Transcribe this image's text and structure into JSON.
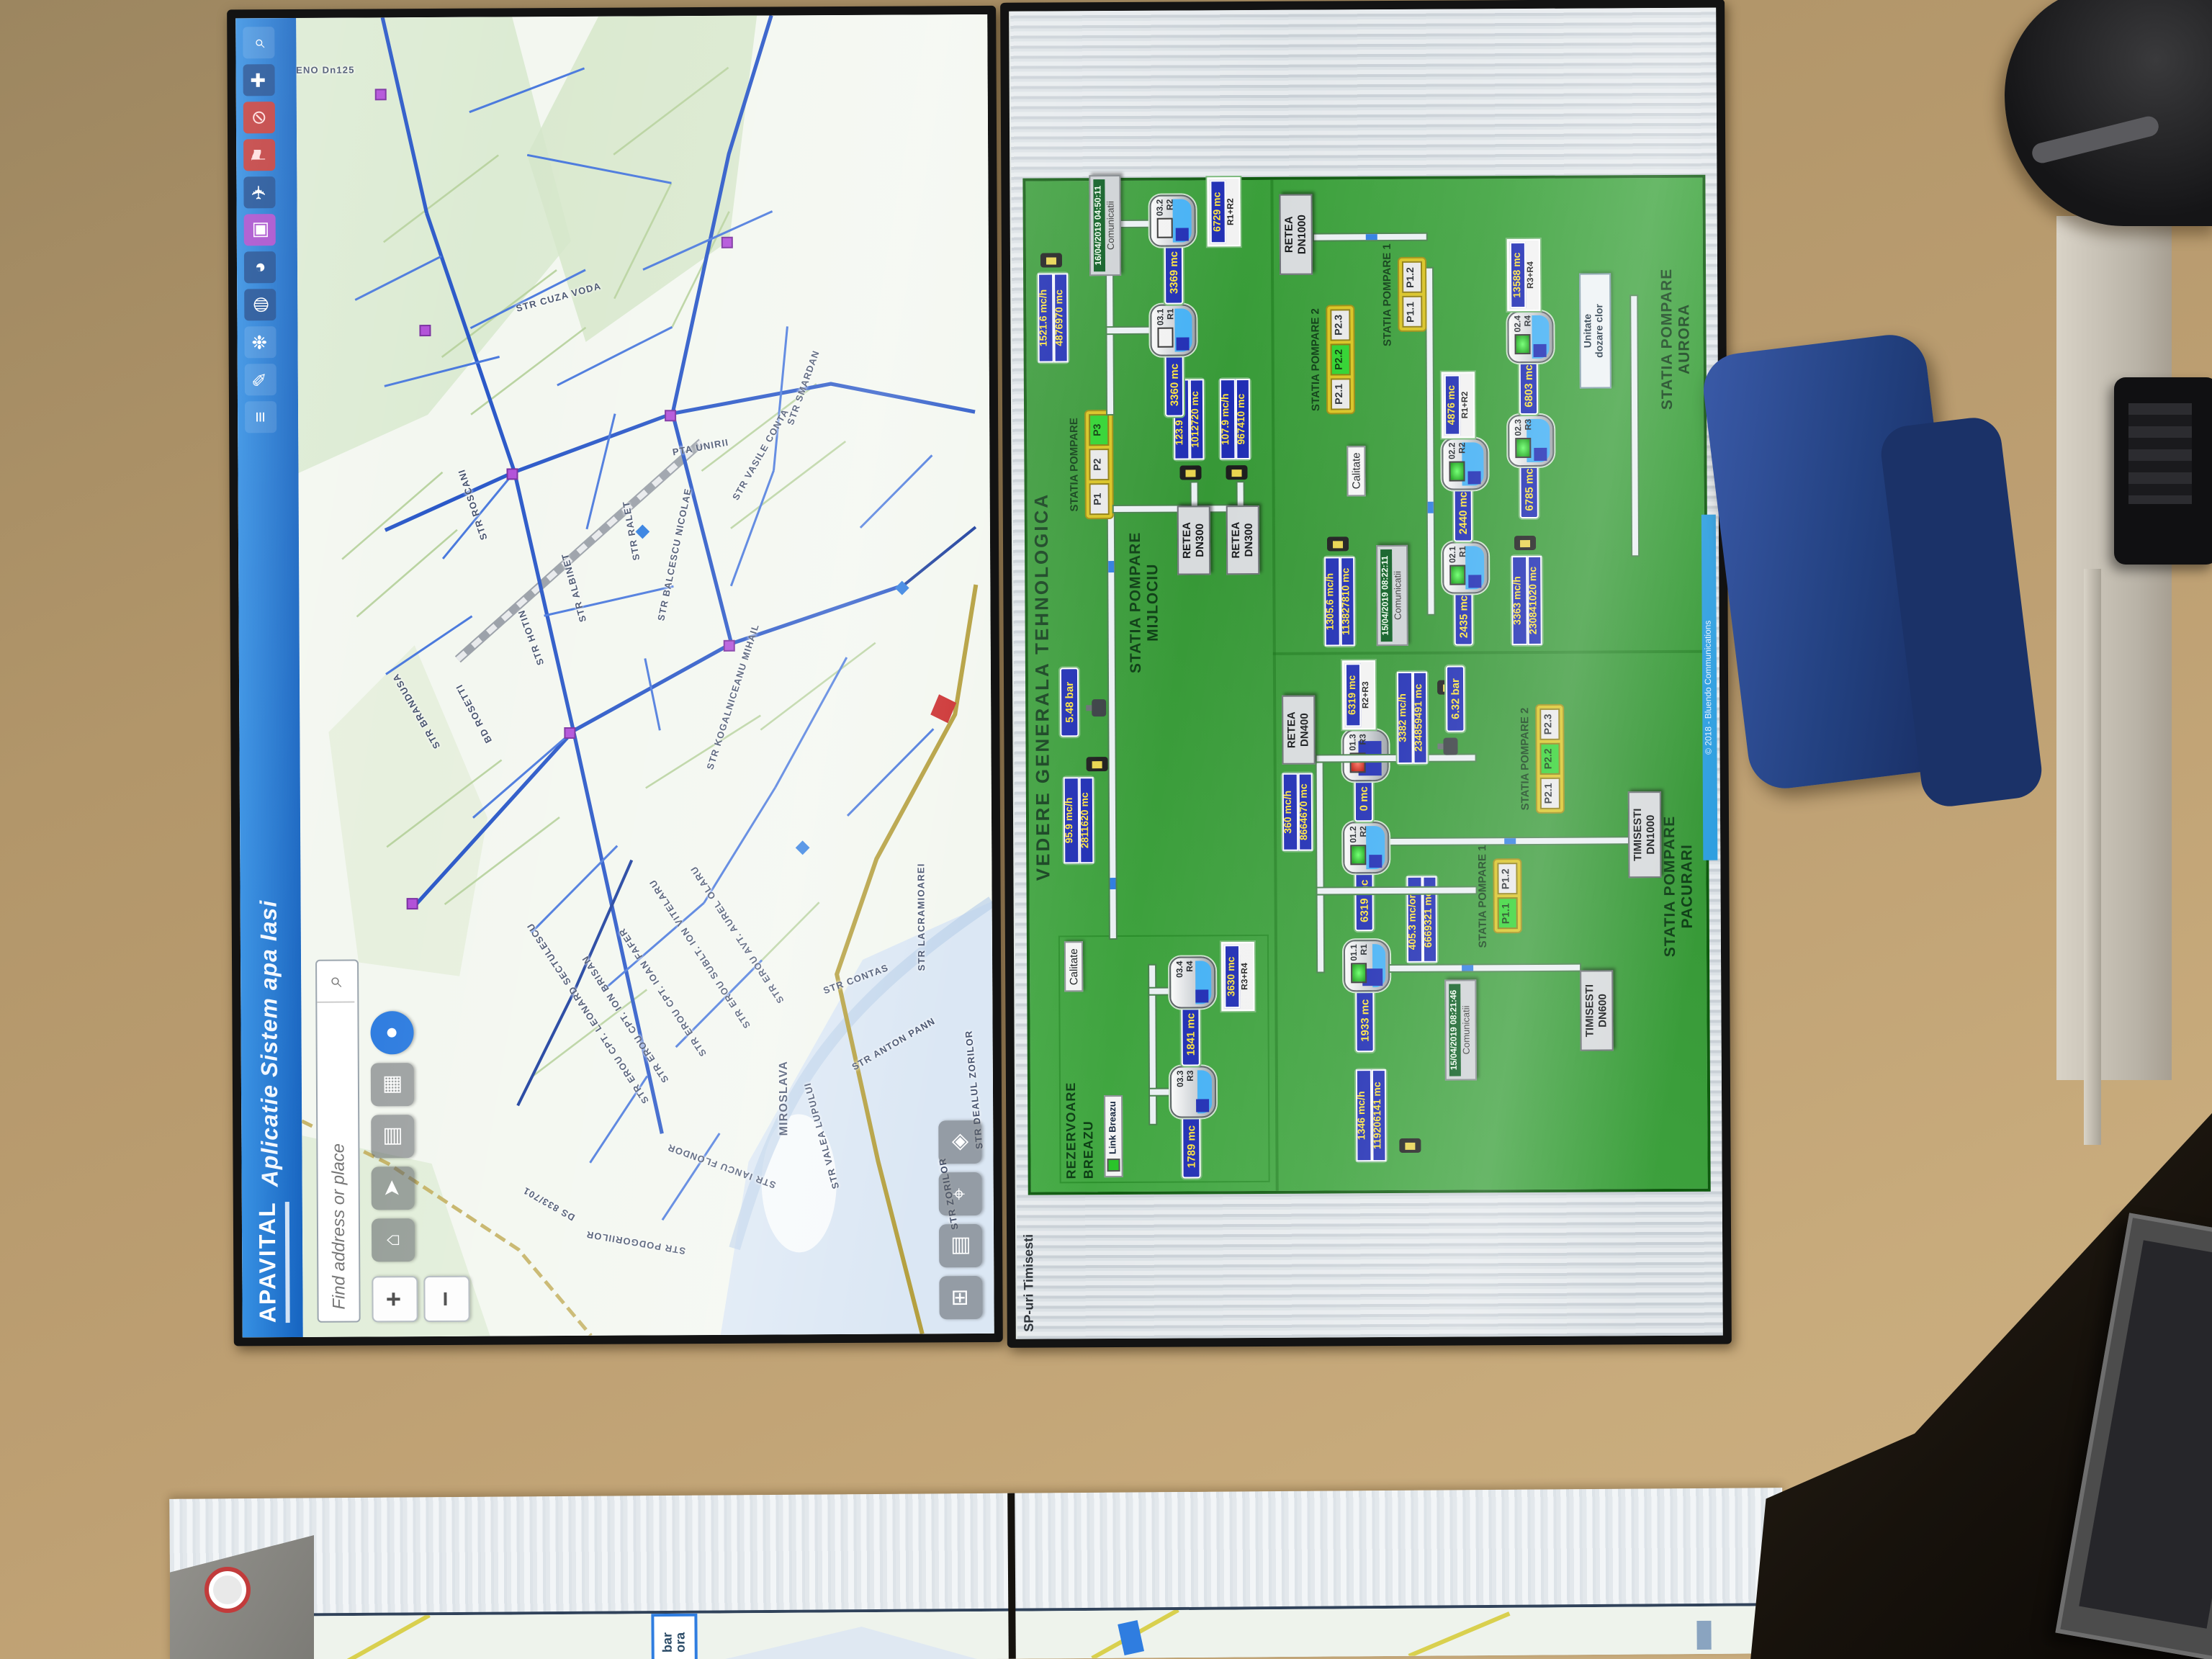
{
  "colors": {
    "titlebar_blue": "#1a6fd0",
    "panel_green": "#3ba33b",
    "value_box_blue": "#1f2db4",
    "value_text_yellow": "#ffe53e",
    "pump_on_green": "#2ed32e",
    "alarm_red": "#cc1111",
    "footer_blue": "#2f9fe0",
    "wall_tan": "#bd9f72"
  },
  "map_screen": {
    "logo": "APAVITAL",
    "title": "Aplicatie Sistem apa Iasi",
    "search_placeholder": "Find address or place",
    "zoom_in": "+",
    "zoom_out": "−",
    "toolbar_icons": [
      {
        "name": "menu-sliders-icon",
        "glyph": "≡"
      },
      {
        "name": "draw-pen-icon",
        "glyph": "✎"
      },
      {
        "name": "palette-icon",
        "glyph": "❉"
      },
      {
        "name": "globe-icon",
        "glyph": "◍"
      },
      {
        "name": "compass-icon",
        "glyph": "◕"
      },
      {
        "name": "frame-icon",
        "glyph": "▣"
      },
      {
        "name": "plane-icon",
        "glyph": "✈"
      },
      {
        "name": "flag-icon",
        "glyph": "⚑"
      },
      {
        "name": "no-entry-icon",
        "glyph": "⊘"
      },
      {
        "name": "add-cross-icon",
        "glyph": "✚"
      },
      {
        "name": "magnifier-icon",
        "glyph": "⌕"
      }
    ],
    "nav_buttons": [
      {
        "name": "home-button",
        "glyph": "⌂"
      },
      {
        "name": "locate-button",
        "glyph": "➤"
      },
      {
        "name": "layers-button",
        "glyph": "▤"
      },
      {
        "name": "basemap-button",
        "glyph": "▦"
      },
      {
        "name": "tracking-button",
        "glyph": "●"
      }
    ],
    "bottom_buttons": [
      {
        "name": "overview-button",
        "glyph": "⊞"
      },
      {
        "name": "legend-button",
        "glyph": "▤"
      },
      {
        "name": "measure-button",
        "glyph": "⌖"
      },
      {
        "name": "bookmark-button",
        "glyph": "◈"
      }
    ],
    "street_labels": [
      "RENO Dn125",
      "BD ROSETTI",
      "STR HOTIN",
      "STR ALBINET",
      "STR BRANDUSA",
      "STR ROSCANI",
      "STR BALCESCU NICOLAE",
      "STR KOGALNICEANU MIHAIL",
      "PTA UNIRII",
      "STR CUZA VODA",
      "STR VASILE CONTA",
      "STR RALET",
      "STR SMARDAN",
      "STR ANTON PANN",
      "STR CONTAS",
      "STR LACRAMIOAREI",
      "STR VALEA LUPULUI",
      "STR ZORILOR",
      "STR DEALUL ZORILOR",
      "STR PODGORIILOR",
      "STR IANCU FLONDOR",
      "DS 833/701",
      "STR EROU CPT. LEONARD SECTULESCU",
      "STR EROU CPT. ION BRISAN",
      "STR EROU CPT. IOAN FAFER",
      "STR EROU SUBLT. ION VITELARU",
      "STR EROU AVT. AUREL OLARU",
      "MIROSLAVA"
    ]
  },
  "scada_screen": {
    "window_title": "SP-uri Timisesti",
    "title": "VEDERE GENERALA TEHNOLOGICA",
    "footer": "© 2018 - Bluendo Communications",
    "breazu": {
      "label": "REZERVOARE\nBREAZU",
      "calitate": "Calitate",
      "link": "Link Breazu",
      "tank1": {
        "value": "1789 mc",
        "id": "03.3",
        "r": "R3"
      },
      "tank2": {
        "value": "1841 mc",
        "id": "03.4",
        "r": "R4"
      },
      "total": {
        "value": "3630 mc",
        "label": "R3+R4"
      }
    },
    "mijlociu": {
      "label": "STATIA POMPARE\nMIJLOCIU",
      "pump_title": "STATIA POMPARE",
      "pumps": [
        "P1",
        "P2",
        "P3"
      ],
      "flow_in": {
        "rate": "95.9 mc/h",
        "total": "2811620 mc"
      },
      "pressure": "5.48 bar",
      "tank1": {
        "value": "3360 mc",
        "id": "03.1",
        "r": "R1"
      },
      "tank2": {
        "value": "3369 mc",
        "id": "03.2",
        "r": "R2"
      },
      "total": {
        "value": "6729 mc",
        "label": "R1+R2"
      },
      "flow_out": {
        "rate": "1521.6 mc/h",
        "total": "4876970 mc"
      },
      "timestamp": {
        "time": "16/04/2019 04:50:11",
        "label": "Comunicatii"
      },
      "retea1": {
        "name": "RETEA\nDN300",
        "rate": "123.9 mc/h",
        "total": "1012720 mc"
      },
      "retea2": {
        "name": "RETEA\nDN300",
        "rate": "107.9 mc/h",
        "total": "967410 mc"
      }
    },
    "aurora": {
      "label": "STATIA POMPARE\nAURORA",
      "flow_in": {
        "rate": "1305.6 mc/h",
        "total": "113827810 mc"
      },
      "timestamp": {
        "time": "15/04/2019 08:22:11",
        "label": "Comunicatii"
      },
      "tank1": {
        "value": "2435 mc",
        "id": "02.1",
        "r": "R1"
      },
      "tank2": {
        "value": "2440 mc",
        "id": "02.2",
        "r": "R2"
      },
      "total12": {
        "value": "4876 mc",
        "label": "R1+R2"
      },
      "flow_mid": {
        "rate": "3363 mc/h",
        "total": "230841020 mc"
      },
      "tank3": {
        "value": "6785 mc",
        "id": "02.3",
        "r": "R3"
      },
      "tank4": {
        "value": "6803 mc",
        "id": "02.4",
        "r": "R4"
      },
      "total34": {
        "value": "13588 mc",
        "label": "R3+R4"
      },
      "sp2": {
        "label": "STATIA POMPARE 2",
        "pumps": [
          "P2.1",
          "P2.2",
          "P2.3"
        ]
      },
      "sp1": {
        "label": "STATIA POMPARE 1",
        "pumps": [
          "P1.1",
          "P1.2"
        ]
      },
      "calitate": "Calitate",
      "dozare": "Unitate\ndozare clor",
      "retea": "RETEA\nDN1000"
    },
    "pacurari": {
      "label": "STATIA POMPARE\nPACURARI",
      "src1": "TIMISESTI\nDN600",
      "src2": "TIMISESTI\nDN1000",
      "tank1": {
        "value": "1933 mc",
        "id": "01.1",
        "r": "R1"
      },
      "flow_in": {
        "rate": "405.3 mc/ora",
        "total": "6669321 mc"
      },
      "timestamp": {
        "time": "15/04/2019 08:21:46",
        "label": "Comunicatii"
      },
      "tank2": {
        "value": "6319 mc",
        "id": "01.2",
        "r": "R2"
      },
      "tank3": {
        "value": "0 mc",
        "id": "01.3",
        "r": "R3"
      },
      "total23": {
        "value": "6319 mc",
        "label": "R2+R3"
      },
      "sp1": {
        "label": "STATIA POMPARE 1",
        "pumps": [
          "P1.1",
          "P1.2"
        ],
        "flow": {
          "rate": "1346 mc/h",
          "total": "119206141 mc"
        }
      },
      "sp2": {
        "label": "STATIA POMPARE 2",
        "pumps": [
          "P2.1",
          "P2.2",
          "P2.3"
        ],
        "flow": {
          "rate": "3382 mc/h",
          "total": "234859491 mc"
        }
      },
      "pressure": "6.32 bar",
      "retea": {
        "name": "RETEA\nDN400",
        "rate": "360 mc/h",
        "total": "8664670 mc"
      }
    }
  },
  "desk_screen": {
    "popup_line1": "bar",
    "popup_line2": "ora"
  }
}
